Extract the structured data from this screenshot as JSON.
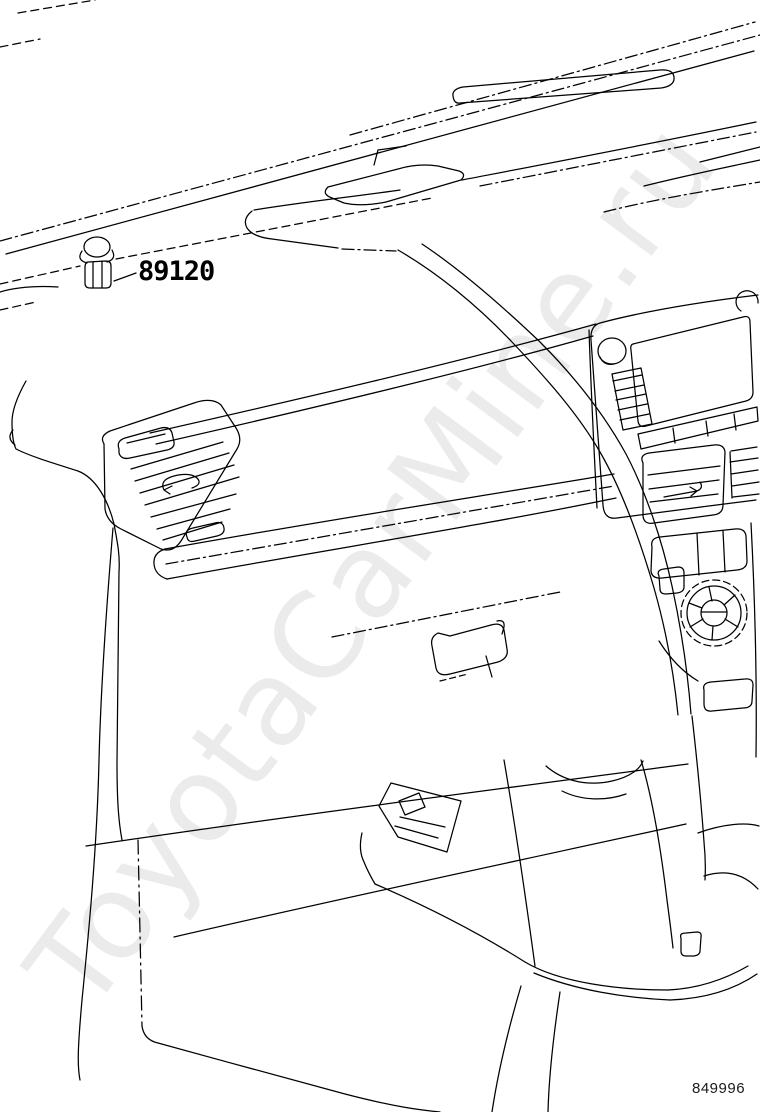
{
  "diagram": {
    "kind": "vehicle-parts-line-drawing",
    "subject": "instrument panel / dashboard interior view",
    "background_color": "#ffffff",
    "line_color": "#000000"
  },
  "callout": {
    "part_number": "89120"
  },
  "figure_number": "849996",
  "watermark": {
    "text": "ToyotaCarMine.ru",
    "color": "#ebebeb",
    "rotation_deg": -53.5
  }
}
